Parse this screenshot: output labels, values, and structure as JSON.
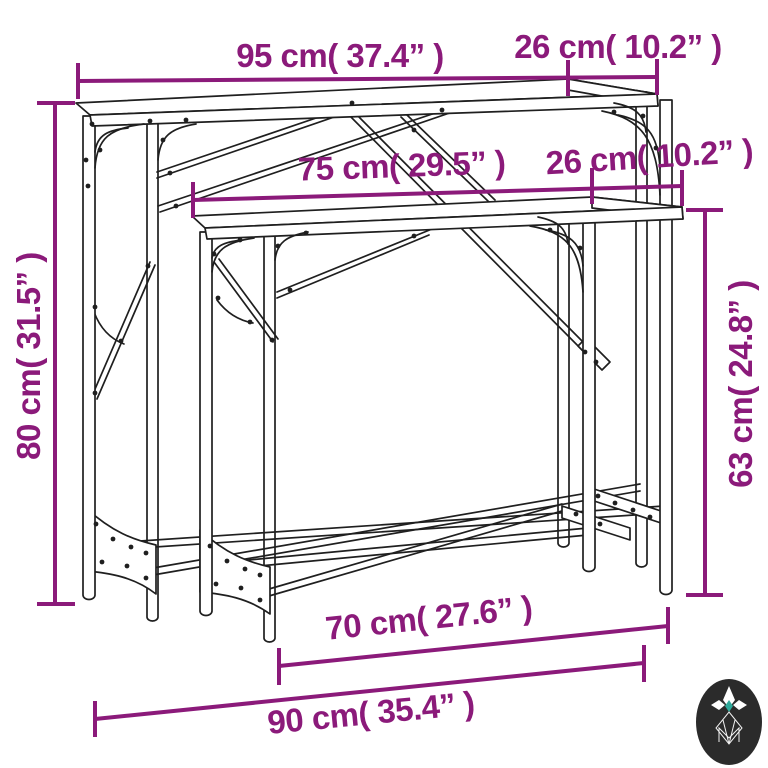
{
  "diagram_type": "product-dimension-diagram",
  "product": "nesting-console-tables",
  "dimensions": {
    "table_large": {
      "width_label": "95 cm( 37.4” )",
      "depth_label": "26 cm( 10.2” )",
      "height_label": "80 cm( 31.5” )"
    },
    "table_small": {
      "width_label": "75 cm( 29.5” )",
      "depth_label": "26 cm( 10.2” )",
      "height_label": "63 cm( 24.8” )"
    },
    "floor_span_inner_label": "70 cm( 27.6” )",
    "floor_span_outer_label": "90 cm( 35.4” )"
  },
  "colors": {
    "dimension": "#8b1a7a",
    "line_art": "#1f1f1f",
    "background": "#ffffff",
    "logo_bg": "#2b2b2b",
    "logo_accent": "#2ea99a"
  },
  "logo": {
    "name": "brand-monogram"
  }
}
